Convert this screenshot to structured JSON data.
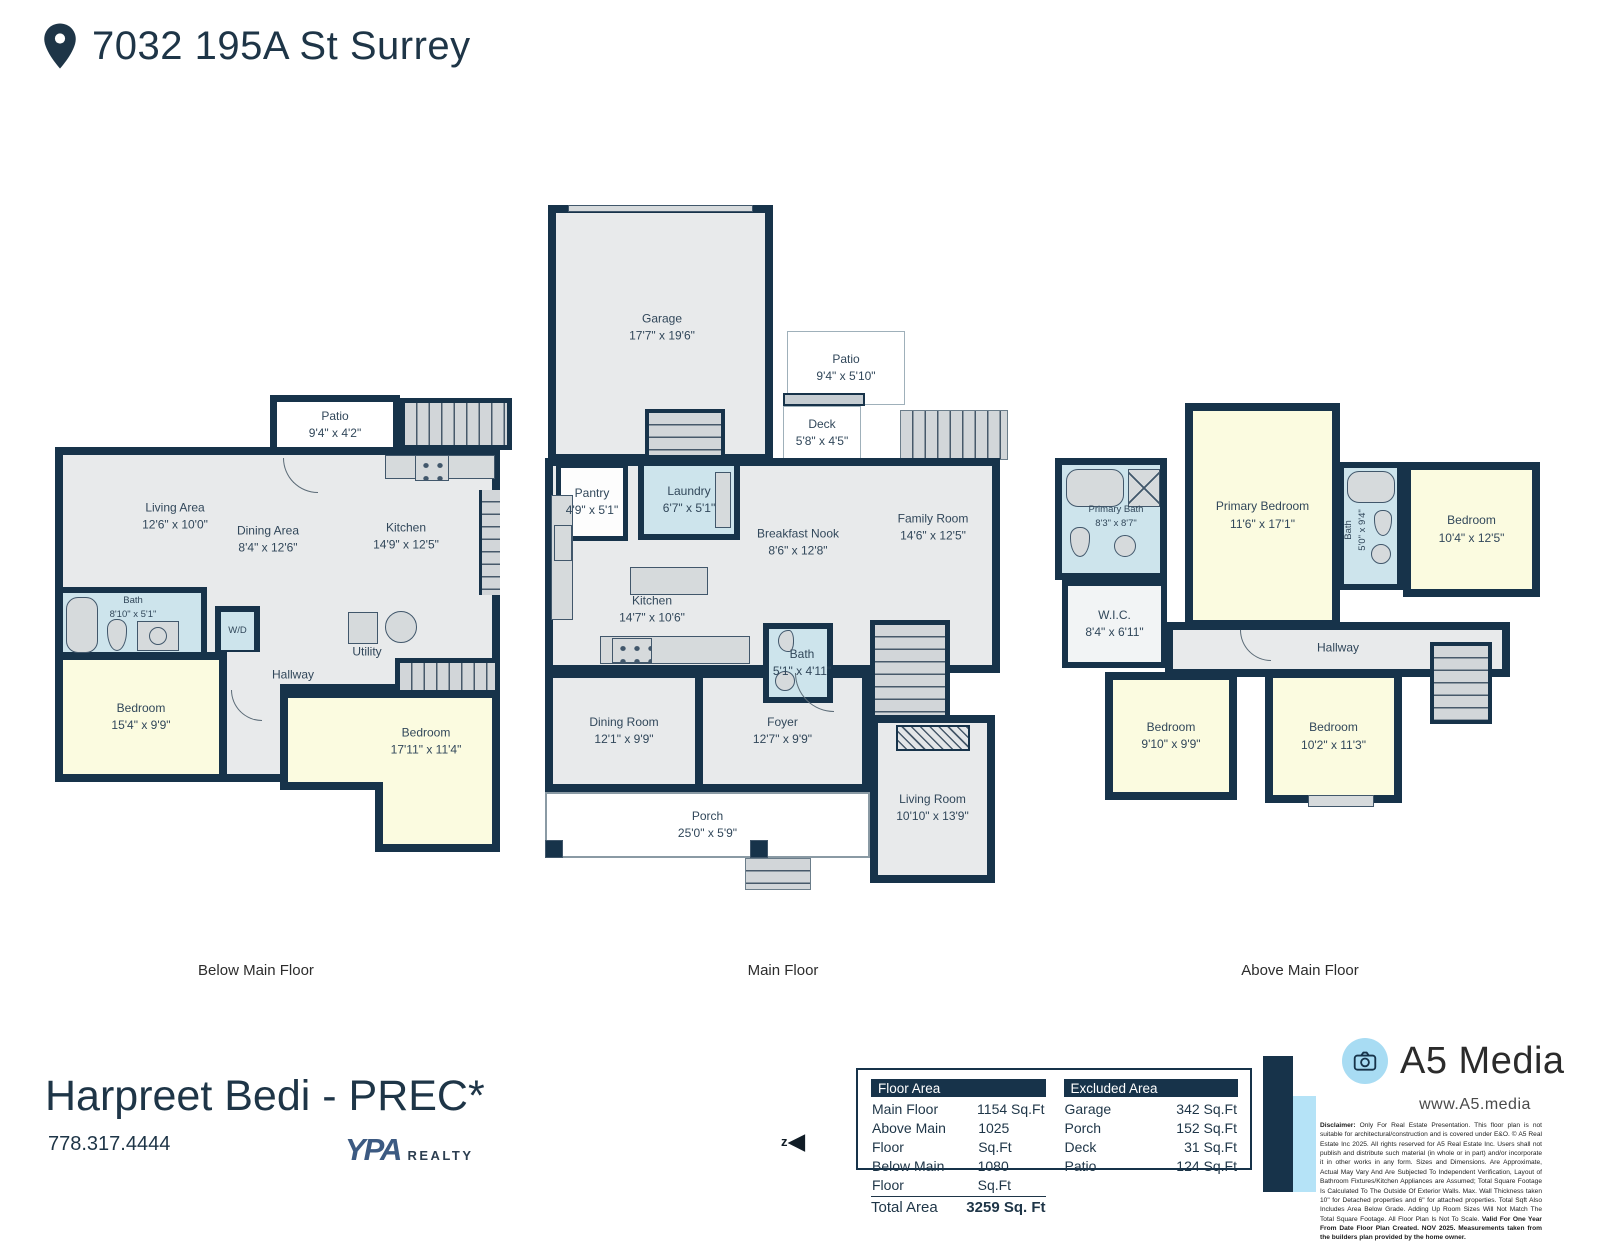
{
  "header": {
    "address": "7032 195A St Surrey"
  },
  "colors": {
    "wall_navy": "#17334a",
    "floor_gray": "#e8eaeb",
    "bedroom_yellow": "#fbfbe0",
    "bath_blue": "#cde4ec",
    "accent_light_blue": "#a8dcf3",
    "stairs_gray": "#d2d6d9"
  },
  "floors": {
    "below": {
      "label": "Below Main Floor",
      "rooms": {
        "patio": {
          "name": "Patio",
          "dims": "9'4\" x 4'2\""
        },
        "living": {
          "name": "Living Area",
          "dims": "12'6\" x 10'0\""
        },
        "dining": {
          "name": "Dining Area",
          "dims": "8'4\" x 12'6\""
        },
        "kitchen": {
          "name": "Kitchen",
          "dims": "14'9\" x 12'5\""
        },
        "bath": {
          "name": "Bath",
          "dims": "8'10\" x 5'1\""
        },
        "wd": {
          "name": "W/D"
        },
        "utility": {
          "name": "Utility"
        },
        "hallway": {
          "name": "Hallway"
        },
        "bedroom1": {
          "name": "Bedroom",
          "dims": "15'4\" x 9'9\""
        },
        "bedroom2": {
          "name": "Bedroom",
          "dims": "17'11\" x 11'4\""
        }
      }
    },
    "main": {
      "label": "Main Floor",
      "rooms": {
        "garage": {
          "name": "Garage",
          "dims": "17'7\" x 19'6\""
        },
        "patio": {
          "name": "Patio",
          "dims": "9'4\" x 5'10\""
        },
        "deck": {
          "name": "Deck",
          "dims": "5'8\" x 4'5\""
        },
        "pantry": {
          "name": "Pantry",
          "dims": "4'9\" x 5'1\""
        },
        "laundry": {
          "name": "Laundry",
          "dims": "6'7\" x 5'1\""
        },
        "breakfast": {
          "name": "Breakfast Nook",
          "dims": "8'6\" x 12'8\""
        },
        "family": {
          "name": "Family Room",
          "dims": "14'6\" x 12'5\""
        },
        "kitchen": {
          "name": "Kitchen",
          "dims": "14'7\" x 10'6\""
        },
        "bath": {
          "name": "Bath",
          "dims": "5'1\" x 4'11\""
        },
        "dining": {
          "name": "Dining Room",
          "dims": "12'1\" x 9'9\""
        },
        "foyer": {
          "name": "Foyer",
          "dims": "12'7\" x 9'9\""
        },
        "living": {
          "name": "Living Room",
          "dims": "10'10\" x 13'9\""
        },
        "porch": {
          "name": "Porch",
          "dims": "25'0\" x 5'9\""
        }
      }
    },
    "above": {
      "label": "Above Main Floor",
      "rooms": {
        "primary_bath": {
          "name": "Primary Bath",
          "dims": "8'3\" x 8'7\""
        },
        "primary_bedroom": {
          "name": "Primary Bedroom",
          "dims": "11'6\" x 17'1\""
        },
        "wic": {
          "name": "W.I.C.",
          "dims": "8'4\" x 6'11\""
        },
        "bath": {
          "name": "Bath",
          "dims": "5'0\" x 9'4\""
        },
        "bedroom1": {
          "name": "Bedroom",
          "dims": "10'4\" x 12'5\""
        },
        "hallway": {
          "name": "Hallway"
        },
        "bedroom2": {
          "name": "Bedroom",
          "dims": "9'10\" x 9'9\""
        },
        "bedroom3": {
          "name": "Bedroom",
          "dims": "10'2\" x 11'3\""
        }
      }
    }
  },
  "tables": {
    "floor_area": {
      "title": "Floor Area",
      "rows": [
        [
          "Main Floor",
          "1154 Sq.Ft"
        ],
        [
          "Above Main Floor",
          "1025 Sq.Ft"
        ],
        [
          "Below Main Floor",
          "1080 Sq.Ft"
        ]
      ],
      "total_label": "Total Area",
      "total_value": "3259 Sq. Ft"
    },
    "excluded_area": {
      "title": "Excluded Area",
      "rows": [
        [
          "Garage",
          "342 Sq.Ft"
        ],
        [
          "Porch",
          "152 Sq.Ft"
        ],
        [
          "Deck",
          "31 Sq.Ft"
        ],
        [
          "Patio",
          "124 Sq.Ft"
        ]
      ]
    }
  },
  "agent": {
    "name": "Harpreet Bedi - PREC*",
    "phone": "778.317.4444",
    "brokerage_mark": "YPA",
    "brokerage_suffix": "REALTY"
  },
  "branding": {
    "company": "A5 Media",
    "website": "www.A5.media",
    "disclaimer_label": "Disclaimer:",
    "disclaimer_body": "Only For Real Estate Presentation. This floor plan is not suitable for architectural/construction and is covered under E&O. © A5 Real Estate Inc 2025. All rights reserved for A5 Real Estate Inc. Users shall not publish and distribute such material (in whole or in part) and/or incorporate it in other works in any form. Sizes and Dimensions. Are Approximate, Actual May Vary And Are Subjected To Independent Verification, Layout of Bathroom Fixtures/Kitchen Appliances are Assumed; Total Square Footage Is Calculated To The Outside Of Exterior Walls. Max. Wall Thickness taken 10\" for Detached properties and 6\" for attached properties. Total Sqft Also Includes Area Below Grade. Adding Up Room Sizes Will Not Match The Total Square Footage. All Floor Plan Is Not To Scale.",
    "disclaimer_bold": "Valid For One Year From Date Floor Plan Created. NOV 2025. Measurements taken from the builders plan provided by the home owner."
  },
  "compass": {
    "label": "z",
    "arrow": "◀"
  }
}
